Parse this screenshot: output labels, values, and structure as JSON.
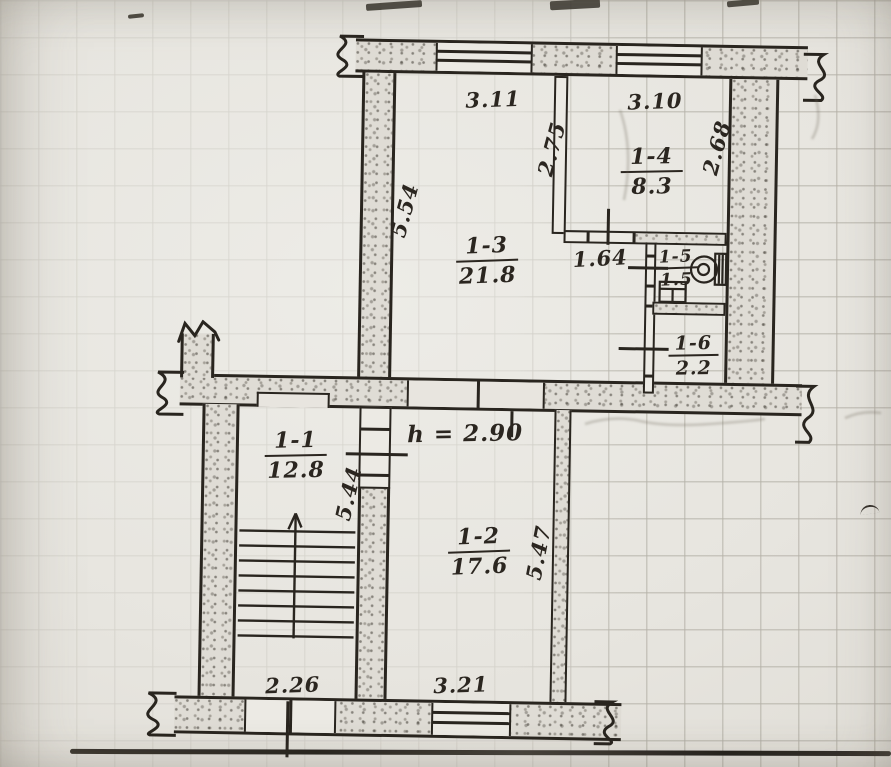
{
  "drawing_title": "apartment floor plan sketch",
  "floor_plan": {
    "ceiling_height_note": "h = 2.90",
    "rooms": [
      {
        "number": "1-1",
        "area": "12.8"
      },
      {
        "number": "1-2",
        "area": "17.6"
      },
      {
        "number": "1-3",
        "area": "21.8"
      },
      {
        "number": "1-4",
        "area": "8.3"
      },
      {
        "number": "1-5",
        "area": "1.5"
      },
      {
        "number": "1-6",
        "area": "2.2"
      }
    ],
    "dimensions": {
      "room13_width": "3.11",
      "room14_width": "3.10",
      "room14_left_height": "2.75",
      "room14_right_height": "2.68",
      "room13_left_height": "5.54",
      "corridor_width": "1.64",
      "hall_wall_height": "5.44",
      "room12_wall_height": "5.47",
      "stairs_width": "2.26",
      "room12_width": "3.21"
    },
    "fixtures": {
      "toilet": "toilet-icon",
      "sink": "sink-icon",
      "stairs_direction": "up-arrow-icon"
    },
    "colors": {
      "paper": "#e8e5df",
      "ink": "#29251f",
      "wall_fill": "#dfdcd5",
      "grid": "#928e82"
    }
  }
}
